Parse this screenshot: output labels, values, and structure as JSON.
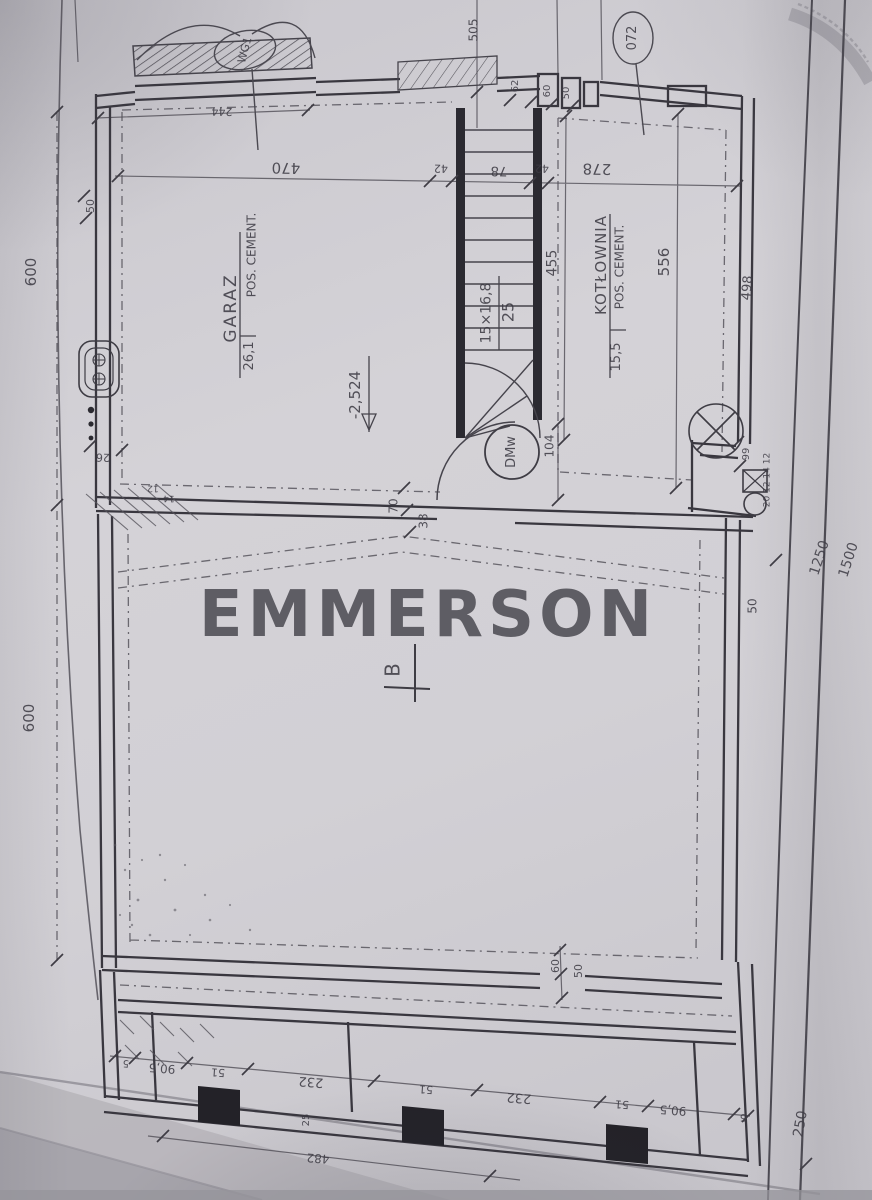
{
  "watermark": {
    "text": "EMMERSON"
  },
  "plan": {
    "type": "architectural-floor-plan",
    "level_marker": "-2,524",
    "section_marker": "B",
    "rooms": [
      {
        "name": "GARAZ",
        "area_m2": "26,1",
        "floor": "POS. CEMENT."
      },
      {
        "name": "KOTŁOWNIA",
        "area_m2": "15,5",
        "floor": "POS. CEMENT."
      }
    ],
    "stairs": {
      "spec": "15×16,8",
      "width": "25"
    },
    "door_marker": "DMw",
    "window_marker": "072",
    "gate_marker": "WG1"
  },
  "colors": {
    "paper": "#d2d0d5",
    "ink": "#46444c",
    "ink_dark": "#26252b",
    "watermark": "#56555c"
  },
  "annotations": [
    {
      "name": "room-label-garaz",
      "text": "GARAZ",
      "x": 232,
      "y": 308,
      "rot": -90,
      "fs": 17,
      "ls": 2
    },
    {
      "name": "room-floor-garaz",
      "text": "POS. CEMENT.",
      "x": 252,
      "y": 255,
      "rot": -90,
      "fs": 12
    },
    {
      "name": "room-area-garaz",
      "text": "26,1",
      "x": 250,
      "y": 356,
      "rot": -90,
      "fs": 13
    },
    {
      "name": "room-label-kotlownia",
      "text": "KOTŁOWNIA",
      "x": 602,
      "y": 265,
      "rot": -90,
      "fs": 15,
      "ls": 1
    },
    {
      "name": "room-floor-kotlownia",
      "text": "POS. CEMENT.",
      "x": 620,
      "y": 267,
      "rot": -90,
      "fs": 12
    },
    {
      "name": "room-area-kotlownia",
      "text": "15,5",
      "x": 617,
      "y": 357,
      "rot": -90,
      "fs": 13
    },
    {
      "name": "stairs-spec",
      "text": "15×16,8",
      "x": 487,
      "y": 313,
      "rot": -90,
      "fs": 14
    },
    {
      "name": "stairs-width",
      "text": "25",
      "x": 509,
      "y": 312,
      "rot": -90,
      "fs": 16
    },
    {
      "name": "level-marker",
      "text": "-2,524",
      "x": 356,
      "y": 395,
      "rot": -90,
      "fs": 15
    },
    {
      "name": "door-marker",
      "text": "DMw",
      "x": 512,
      "y": 452,
      "rot": -90,
      "fs": 13
    },
    {
      "name": "window-marker",
      "text": "072",
      "x": 633,
      "y": 38,
      "rot": -90,
      "fs": 13
    },
    {
      "name": "gate-marker",
      "text": "WG1",
      "x": 245,
      "y": 50,
      "rot": -75,
      "fs": 11
    },
    {
      "name": "section-marker-b",
      "text": "B",
      "x": 393,
      "y": 670,
      "rot": -90,
      "fs": 20
    },
    {
      "name": "dim-505",
      "text": "505",
      "x": 474,
      "y": 30,
      "rot": -90,
      "fs": 12
    },
    {
      "name": "dim-244",
      "text": "244",
      "x": 222,
      "y": 111,
      "rot": 181,
      "fs": 11
    },
    {
      "name": "dim-470",
      "text": "470",
      "x": 286,
      "y": 167,
      "rot": 181,
      "fs": 15
    },
    {
      "name": "dim-42a",
      "text": "42",
      "x": 441,
      "y": 168,
      "rot": 181,
      "fs": 11
    },
    {
      "name": "dim-78",
      "text": "78",
      "x": 499,
      "y": 170,
      "rot": 181,
      "fs": 13
    },
    {
      "name": "dim-42b",
      "text": "42",
      "x": 542,
      "y": 168,
      "rot": 181,
      "fs": 11
    },
    {
      "name": "dim-278",
      "text": "278",
      "x": 597,
      "y": 168,
      "rot": 181,
      "fs": 15
    },
    {
      "name": "dim-62",
      "text": "62",
      "x": 516,
      "y": 86,
      "rot": -90,
      "fs": 10
    },
    {
      "name": "dim-60-top",
      "text": "60",
      "x": 548,
      "y": 91,
      "rot": -90,
      "fs": 10
    },
    {
      "name": "dim-50-top",
      "text": "50",
      "x": 567,
      "y": 93,
      "rot": -90,
      "fs": 10
    },
    {
      "name": "dim-50-left",
      "text": "50",
      "x": 91,
      "y": 206,
      "rot": -90,
      "fs": 11
    },
    {
      "name": "dim-600-upper",
      "text": "600",
      "x": 32,
      "y": 272,
      "rot": -90,
      "fs": 15
    },
    {
      "name": "dim-600-lower",
      "text": "600",
      "x": 30,
      "y": 718,
      "rot": -90,
      "fs": 15
    },
    {
      "name": "dim-455",
      "text": "455",
      "x": 553,
      "y": 263,
      "rot": -90,
      "fs": 14
    },
    {
      "name": "dim-556",
      "text": "556",
      "x": 665,
      "y": 262,
      "rot": -90,
      "fs": 15
    },
    {
      "name": "dim-498",
      "text": "498",
      "x": 748,
      "y": 288,
      "rot": -85,
      "fs": 13
    },
    {
      "name": "dim-104",
      "text": "104",
      "x": 550,
      "y": 446,
      "rot": -90,
      "fs": 12
    },
    {
      "name": "dim-70",
      "text": "70",
      "x": 394,
      "y": 506,
      "rot": -90,
      "fs": 12
    },
    {
      "name": "dim-38",
      "text": "38",
      "x": 424,
      "y": 521,
      "rot": -90,
      "fs": 12
    },
    {
      "name": "dim-26",
      "text": "26",
      "x": 103,
      "y": 457,
      "rot": 181,
      "fs": 11
    },
    {
      "name": "dim-12",
      "text": "12",
      "x": 153,
      "y": 487,
      "rot": 181,
      "fs": 9
    },
    {
      "name": "dim-14",
      "text": "14",
      "x": 169,
      "y": 497,
      "rot": 181,
      "fs": 9
    },
    {
      "name": "dim-99",
      "text": "99",
      "x": 747,
      "y": 454,
      "rot": -90,
      "fs": 10
    },
    {
      "name": "dim-chain-annex",
      "text": "20 12 14 12",
      "x": 768,
      "y": 480,
      "rot": -90,
      "fs": 9
    },
    {
      "name": "dim-1250",
      "text": "1250",
      "x": 820,
      "y": 558,
      "rot": -72,
      "fs": 14
    },
    {
      "name": "dim-1500",
      "text": "1500",
      "x": 849,
      "y": 560,
      "rot": -72,
      "fs": 14
    },
    {
      "name": "dim-50-right",
      "text": "50",
      "x": 753,
      "y": 606,
      "rot": -90,
      "fs": 12
    },
    {
      "name": "dim-250",
      "text": "250",
      "x": 801,
      "y": 1124,
      "rot": -80,
      "fs": 14
    },
    {
      "name": "dim-60-mid",
      "text": "60",
      "x": 556,
      "y": 966,
      "rot": -90,
      "fs": 11
    },
    {
      "name": "dim-50-mid",
      "text": "50",
      "x": 579,
      "y": 971,
      "rot": -90,
      "fs": 11
    },
    {
      "name": "dim-5a",
      "text": "5",
      "x": 126,
      "y": 1062,
      "rot": 184,
      "fs": 10
    },
    {
      "name": "dim-905a",
      "text": "90,5",
      "x": 162,
      "y": 1068,
      "rot": 184,
      "fs": 12
    },
    {
      "name": "dim-51a",
      "text": "51",
      "x": 218,
      "y": 1072,
      "rot": 184,
      "fs": 11
    },
    {
      "name": "dim-232a",
      "text": "232",
      "x": 311,
      "y": 1081,
      "rot": 184,
      "fs": 13
    },
    {
      "name": "dim-51b",
      "text": "51",
      "x": 426,
      "y": 1089,
      "rot": 184,
      "fs": 11
    },
    {
      "name": "dim-232b",
      "text": "232",
      "x": 519,
      "y": 1097,
      "rot": 184,
      "fs": 13
    },
    {
      "name": "dim-51c",
      "text": "51",
      "x": 622,
      "y": 1104,
      "rot": 184,
      "fs": 11
    },
    {
      "name": "dim-905b",
      "text": "90,5",
      "x": 673,
      "y": 1110,
      "rot": 184,
      "fs": 12
    },
    {
      "name": "dim-5b",
      "text": "5",
      "x": 743,
      "y": 1116,
      "rot": 184,
      "fs": 10
    },
    {
      "name": "dim-25",
      "text": "25",
      "x": 307,
      "y": 1120,
      "rot": -90,
      "fs": 10
    },
    {
      "name": "dim-482",
      "text": "482",
      "x": 318,
      "y": 1158,
      "rot": 184,
      "fs": 12
    }
  ]
}
